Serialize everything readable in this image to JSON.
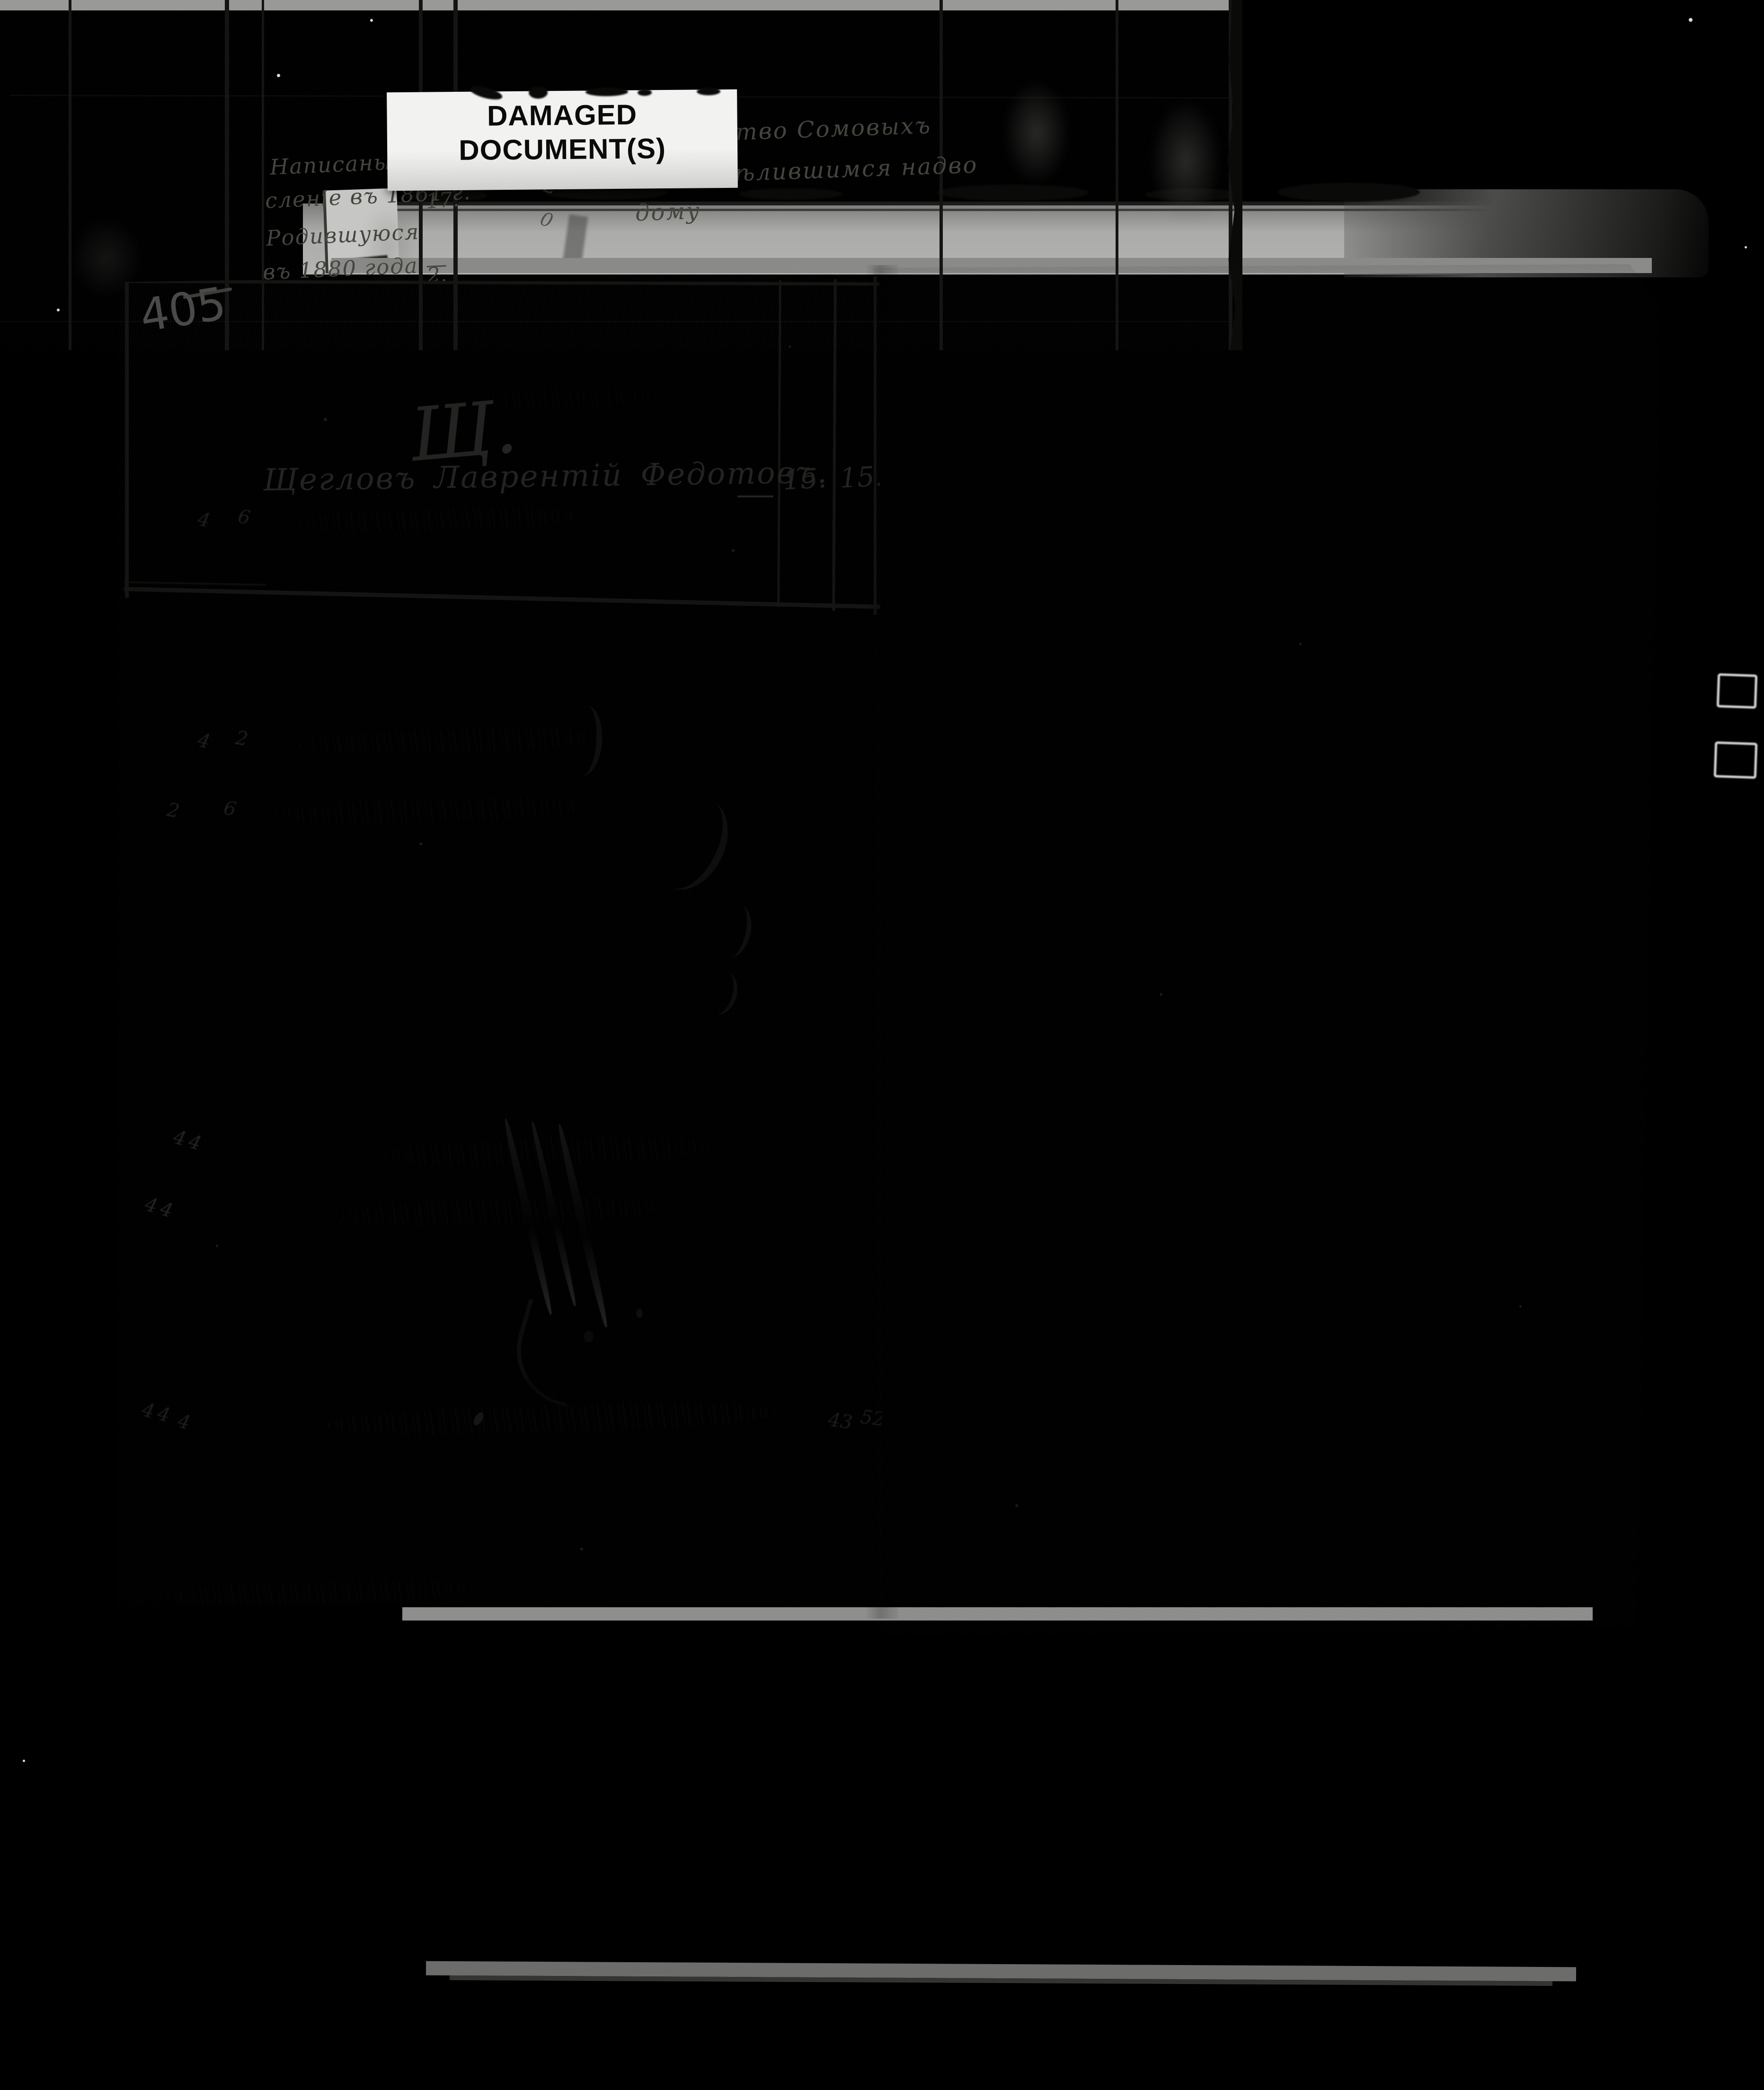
{
  "photo": {
    "damaged_label": {
      "line1": "DAMAGED",
      "line2": "DOCUMENT(S)"
    }
  },
  "left_page": {
    "page_number": "405",
    "section_letter": "Щ.",
    "entry": {
      "name": "Щегловъ Лаврентій Федотовъ.",
      "dash": "—",
      "col1": "15.",
      "col2": "15."
    },
    "ghost_digits": [
      "4",
      "6",
      "4",
      "2",
      "2",
      "6",
      "44",
      "44",
      "44",
      "4",
      "43",
      "52"
    ]
  },
  "bottom_page": {
    "left_note": {
      "line1": "Написаны зачи-",
      "line2": "сленіе въ 1861 г.",
      "num1": "17.",
      "line3": "Родившуюся",
      "line4": "въ 1880 года —",
      "num2": "2."
    },
    "right_note": {
      "line1": "Семейство Сомовыхъ",
      "line2": "по раздѣлившимся надво",
      "line3": "дому"
    },
    "column_digits": [
      "8",
      "2",
      "0"
    ]
  }
}
